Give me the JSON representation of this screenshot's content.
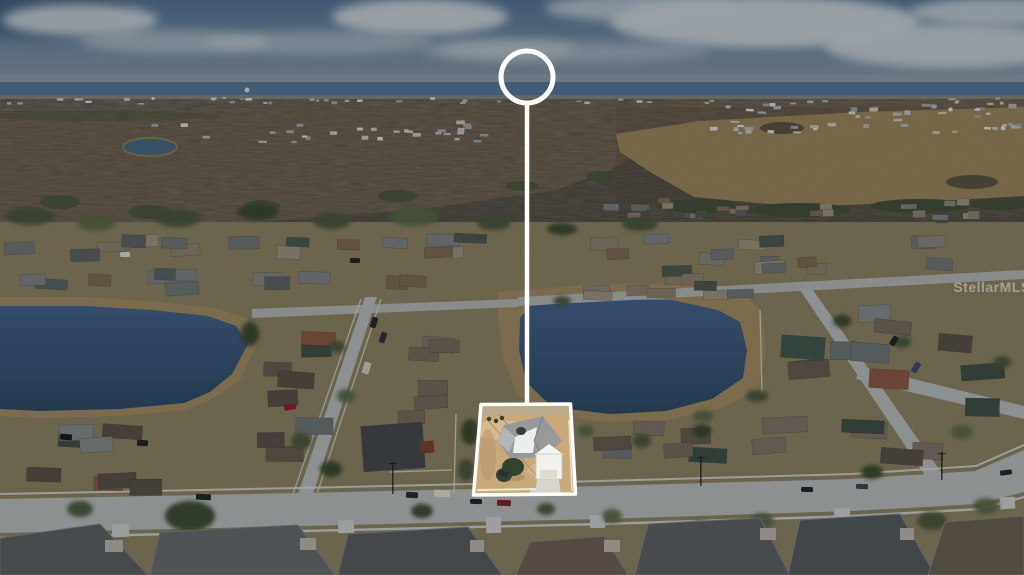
{
  "meta": {
    "type": "aerial-listing-photo",
    "description": "Dimmed aerial drone photo of suburban neighborhood with highlighted subject property, connector line and circle marker"
  },
  "watermark": {
    "text": "StellarMLS"
  },
  "marker": {
    "color": "#ffffff",
    "circle": {
      "cx": 527,
      "cy": 77,
      "r": 26,
      "stroke_width": 5
    },
    "line": {
      "x": 527,
      "y1": 102,
      "y2": 405,
      "width": 4.5
    },
    "lot_outline": "481,404.5 570.5,404 575.5,494 473.5,495",
    "outline_width": 3.5
  },
  "overlay": {
    "color": "#000000",
    "opacity": 0.22
  },
  "colors": {
    "sky_top": "#547291",
    "sky_low": "#93a0ab",
    "cloud": "#c9d1d8",
    "haze": "#8fa0ae",
    "horizon_water": "#527897",
    "distant_land": "#83837b",
    "forest": "#847767",
    "forest_dark": "#5c5247",
    "evergreen": "#49553d",
    "field": "#a28e63",
    "pond": "#476884",
    "ground": "#948b6c",
    "shore": "#9c8962",
    "lake_top": "#44628a",
    "lake_deep": "#2f4a66",
    "road": "#b4b9ba",
    "sidewalk": "#ced2d3",
    "drive": "#c8cbcc",
    "fence": "#d8d5cb",
    "lot_dirt": "#c9a87a",
    "lot_dirt_light": "#dcc094",
    "lot_dirt_dark": "#b3926a",
    "lot_grass": "#b9ab8c",
    "lot_roof": "#97999b",
    "lot_roof_lit": "#eceeed",
    "lot_roof_side": "#b3b6b6",
    "lot_white": "#f1f1ee",
    "lot_drive": "#d6d4cb",
    "lot_tree": "#31422f",
    "lot_fence": "#ebe8df"
  },
  "tree_colors": [
    "#49553d",
    "#59684a",
    "#39462f"
  ],
  "palettes": {
    "far": [
      "#d8dadb",
      "#aeb2b4",
      "#c8c2b4",
      "#9aa0a3",
      "#bdbfc0"
    ],
    "mid": [
      "#6f7577",
      "#7b8184",
      "#8a7f6d",
      "#5d6466",
      "#7d6a56",
      "#87837a",
      "#4e5a50",
      "#9a917f"
    ],
    "big": [
      "#6e7476",
      "#7e746a",
      "#59514a",
      "#3f4f46",
      "#8a5a48",
      "#756b5e",
      "#828889",
      "#675d52"
    ]
  },
  "bands": [
    {
      "x": 0,
      "y": 97,
      "w": 1024,
      "h": 8,
      "n": 46,
      "w0": 3,
      "w1": 7,
      "h0": 1.5,
      "h1": 3,
      "r": 2,
      "p": "far"
    },
    {
      "x": 148,
      "y": 120,
      "w": 350,
      "h": 24,
      "n": 30,
      "w0": 4,
      "w1": 9,
      "h0": 2,
      "h1": 4,
      "r": 3,
      "p": "far"
    },
    {
      "x": 698,
      "y": 102,
      "w": 326,
      "h": 32,
      "n": 48,
      "w0": 4,
      "w1": 10,
      "h0": 2,
      "h1": 4.5,
      "r": 3,
      "p": "far"
    },
    {
      "x": 598,
      "y": 198,
      "w": 426,
      "h": 26,
      "n": 24,
      "w0": 10,
      "w1": 17,
      "h0": 4.5,
      "h1": 7.5,
      "r": 3,
      "p": "mid"
    },
    {
      "x": 2,
      "y": 231,
      "w": 508,
      "h": 32,
      "n": 16,
      "w0": 20,
      "w1": 33,
      "h0": 9,
      "h1": 13,
      "r": 4,
      "p": "mid"
    },
    {
      "x": 2,
      "y": 266,
      "w": 498,
      "h": 30,
      "n": 12,
      "w0": 20,
      "w1": 35,
      "h0": 10,
      "h1": 14,
      "r": 4,
      "p": "mid"
    },
    {
      "x": 545,
      "y": 234,
      "w": 475,
      "h": 52,
      "n": 18,
      "w0": 18,
      "w1": 31,
      "h0": 9,
      "h1": 13,
      "r": 5,
      "p": "mid"
    },
    {
      "x": 744,
      "y": 298,
      "w": 278,
      "h": 168,
      "n": 16,
      "w0": 26,
      "w1": 45,
      "h0": 13,
      "h1": 19,
      "r": 6,
      "p": "big"
    },
    {
      "x": 256,
      "y": 316,
      "w": 82,
      "h": 162,
      "n": 8,
      "w0": 26,
      "w1": 38,
      "h0": 13,
      "h1": 17,
      "r": 5,
      "p": "big"
    },
    {
      "x": 396,
      "y": 316,
      "w": 70,
      "h": 118,
      "n": 6,
      "w0": 24,
      "w1": 34,
      "h0": 12,
      "h1": 16,
      "r": 5,
      "p": "big"
    },
    {
      "x": 0,
      "y": 413,
      "w": 204,
      "h": 86,
      "n": 8,
      "w0": 26,
      "w1": 40,
      "h0": 13,
      "h1": 17,
      "r": 5,
      "p": "big"
    },
    {
      "x": 585,
      "y": 418,
      "w": 180,
      "h": 62,
      "n": 6,
      "w0": 28,
      "w1": 40,
      "h0": 13,
      "h1": 17,
      "r": 4,
      "p": "big"
    },
    {
      "x": 520,
      "y": 280,
      "w": 245,
      "h": 22,
      "n": 7,
      "w0": 20,
      "w1": 29,
      "h0": 8,
      "h1": 11,
      "r": 3,
      "p": "mid"
    }
  ],
  "trees": [
    [
      30,
      216,
      24,
      9,
      0
    ],
    [
      96,
      223,
      19,
      8,
      1
    ],
    [
      178,
      218,
      23,
      9,
      0
    ],
    [
      258,
      212,
      21,
      8,
      2
    ],
    [
      332,
      221,
      19,
      8,
      0
    ],
    [
      414,
      217,
      25,
      9,
      1
    ],
    [
      494,
      223,
      17,
      7,
      0
    ],
    [
      562,
      229,
      15,
      6,
      2
    ],
    [
      640,
      224,
      18,
      7,
      0
    ],
    [
      250,
      334,
      9,
      12,
      2
    ],
    [
      337,
      347,
      8,
      6,
      0
    ],
    [
      346,
      396,
      9,
      7,
      1
    ],
    [
      301,
      441,
      10,
      8,
      0
    ],
    [
      331,
      469,
      11,
      8,
      2
    ],
    [
      470,
      432,
      9,
      13,
      2
    ],
    [
      466,
      470,
      8,
      11,
      0
    ],
    [
      586,
      431,
      8,
      6,
      1
    ],
    [
      642,
      441,
      9,
      7,
      0
    ],
    [
      702,
      431,
      9,
      7,
      2
    ],
    [
      757,
      396,
      11,
      6,
      0
    ],
    [
      703,
      416,
      10,
      6,
      1
    ],
    [
      562,
      301,
      9,
      5,
      0
    ],
    [
      842,
      321,
      9,
      6,
      2
    ],
    [
      902,
      342,
      9,
      6,
      0
    ],
    [
      962,
      432,
      11,
      7,
      1
    ],
    [
      1002,
      362,
      9,
      6,
      0
    ],
    [
      872,
      472,
      11,
      7,
      2
    ],
    [
      190,
      516,
      25,
      15,
      2
    ],
    [
      700,
      529,
      13,
      8,
      0
    ],
    [
      762,
      521,
      12,
      8,
      1
    ],
    [
      932,
      521,
      15,
      9,
      0
    ],
    [
      986,
      506,
      13,
      8,
      1
    ],
    [
      80,
      509,
      13,
      8,
      0
    ],
    [
      422,
      511,
      11,
      7,
      2
    ],
    [
      546,
      509,
      9,
      6,
      0
    ],
    [
      612,
      516,
      10,
      7,
      1
    ]
  ],
  "cars": [
    [
      196,
      494,
      15,
      6,
      "#22282c",
      3
    ],
    [
      406,
      492,
      12,
      6,
      "#2b3135",
      3
    ],
    [
      434,
      490,
      16,
      7,
      "#ded9d1",
      2
    ],
    [
      470,
      499,
      12,
      5,
      "#23282c",
      2
    ],
    [
      497,
      500,
      14,
      6,
      "#7e2433",
      2
    ],
    [
      801,
      487,
      12,
      5,
      "#23282c",
      2
    ],
    [
      856,
      484,
      12,
      5,
      "#3e444b",
      2
    ],
    [
      1000,
      470,
      12,
      5,
      "#262b30",
      -8
    ],
    [
      371,
      317,
      6,
      11,
      "#23282c",
      18
    ],
    [
      380,
      332,
      6,
      11,
      "#31373c",
      18
    ],
    [
      363,
      362,
      7,
      12,
      "#cac7c0",
      16
    ],
    [
      284,
      404,
      12,
      6,
      "#8a2633",
      -8
    ],
    [
      913,
      362,
      6,
      11,
      "#3b5068",
      32
    ],
    [
      891,
      336,
      6,
      10,
      "#23282c",
      32
    ],
    [
      60,
      434,
      12,
      6,
      "#171c1f",
      4
    ],
    [
      137,
      440,
      11,
      6,
      "#22272b",
      4
    ],
    [
      350,
      258,
      10,
      5,
      "#23282c",
      0
    ],
    [
      120,
      252,
      10,
      5,
      "#d9d7d1",
      0
    ]
  ],
  "clouds": [
    [
      80,
      20,
      78,
      16,
      0.9
    ],
    [
      175,
      42,
      95,
      12,
      0.55
    ],
    [
      420,
      17,
      88,
      18,
      0.95
    ],
    [
      320,
      43,
      115,
      12,
      0.5
    ],
    [
      565,
      52,
      145,
      11,
      0.45
    ],
    [
      765,
      22,
      155,
      26,
      0.95
    ],
    [
      950,
      46,
      125,
      22,
      0.9
    ],
    [
      640,
      8,
      95,
      14,
      0.75
    ],
    [
      995,
      12,
      85,
      14,
      0.85
    ],
    [
      505,
      48,
      70,
      10,
      0.5
    ]
  ]
}
